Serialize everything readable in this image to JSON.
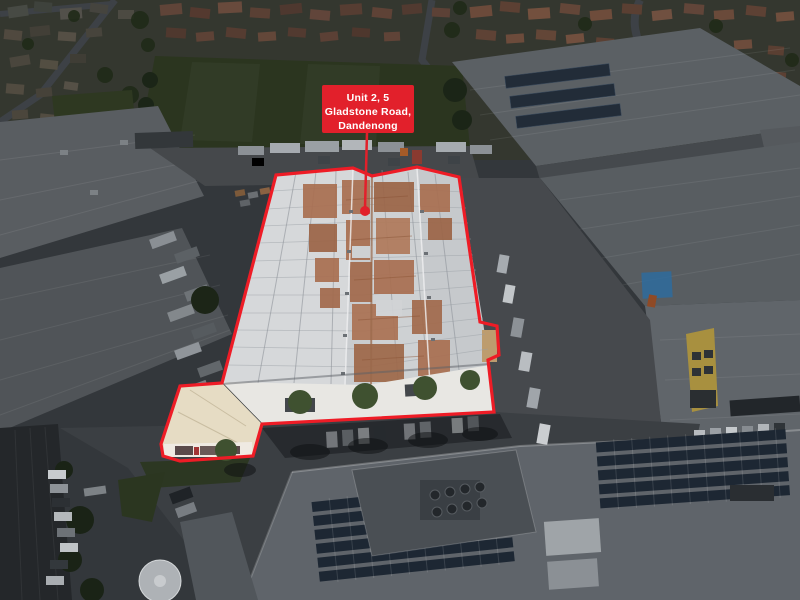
{
  "annotation": {
    "label_line1": "Unit 2, 5",
    "label_line2": "Gladstone Road,",
    "label_line3": "Dandenong",
    "label_bg_color": "#e2202b",
    "label_text_color": "#ffffff",
    "outline_color": "#ee1c26",
    "leader_color": "#e2202b"
  }
}
